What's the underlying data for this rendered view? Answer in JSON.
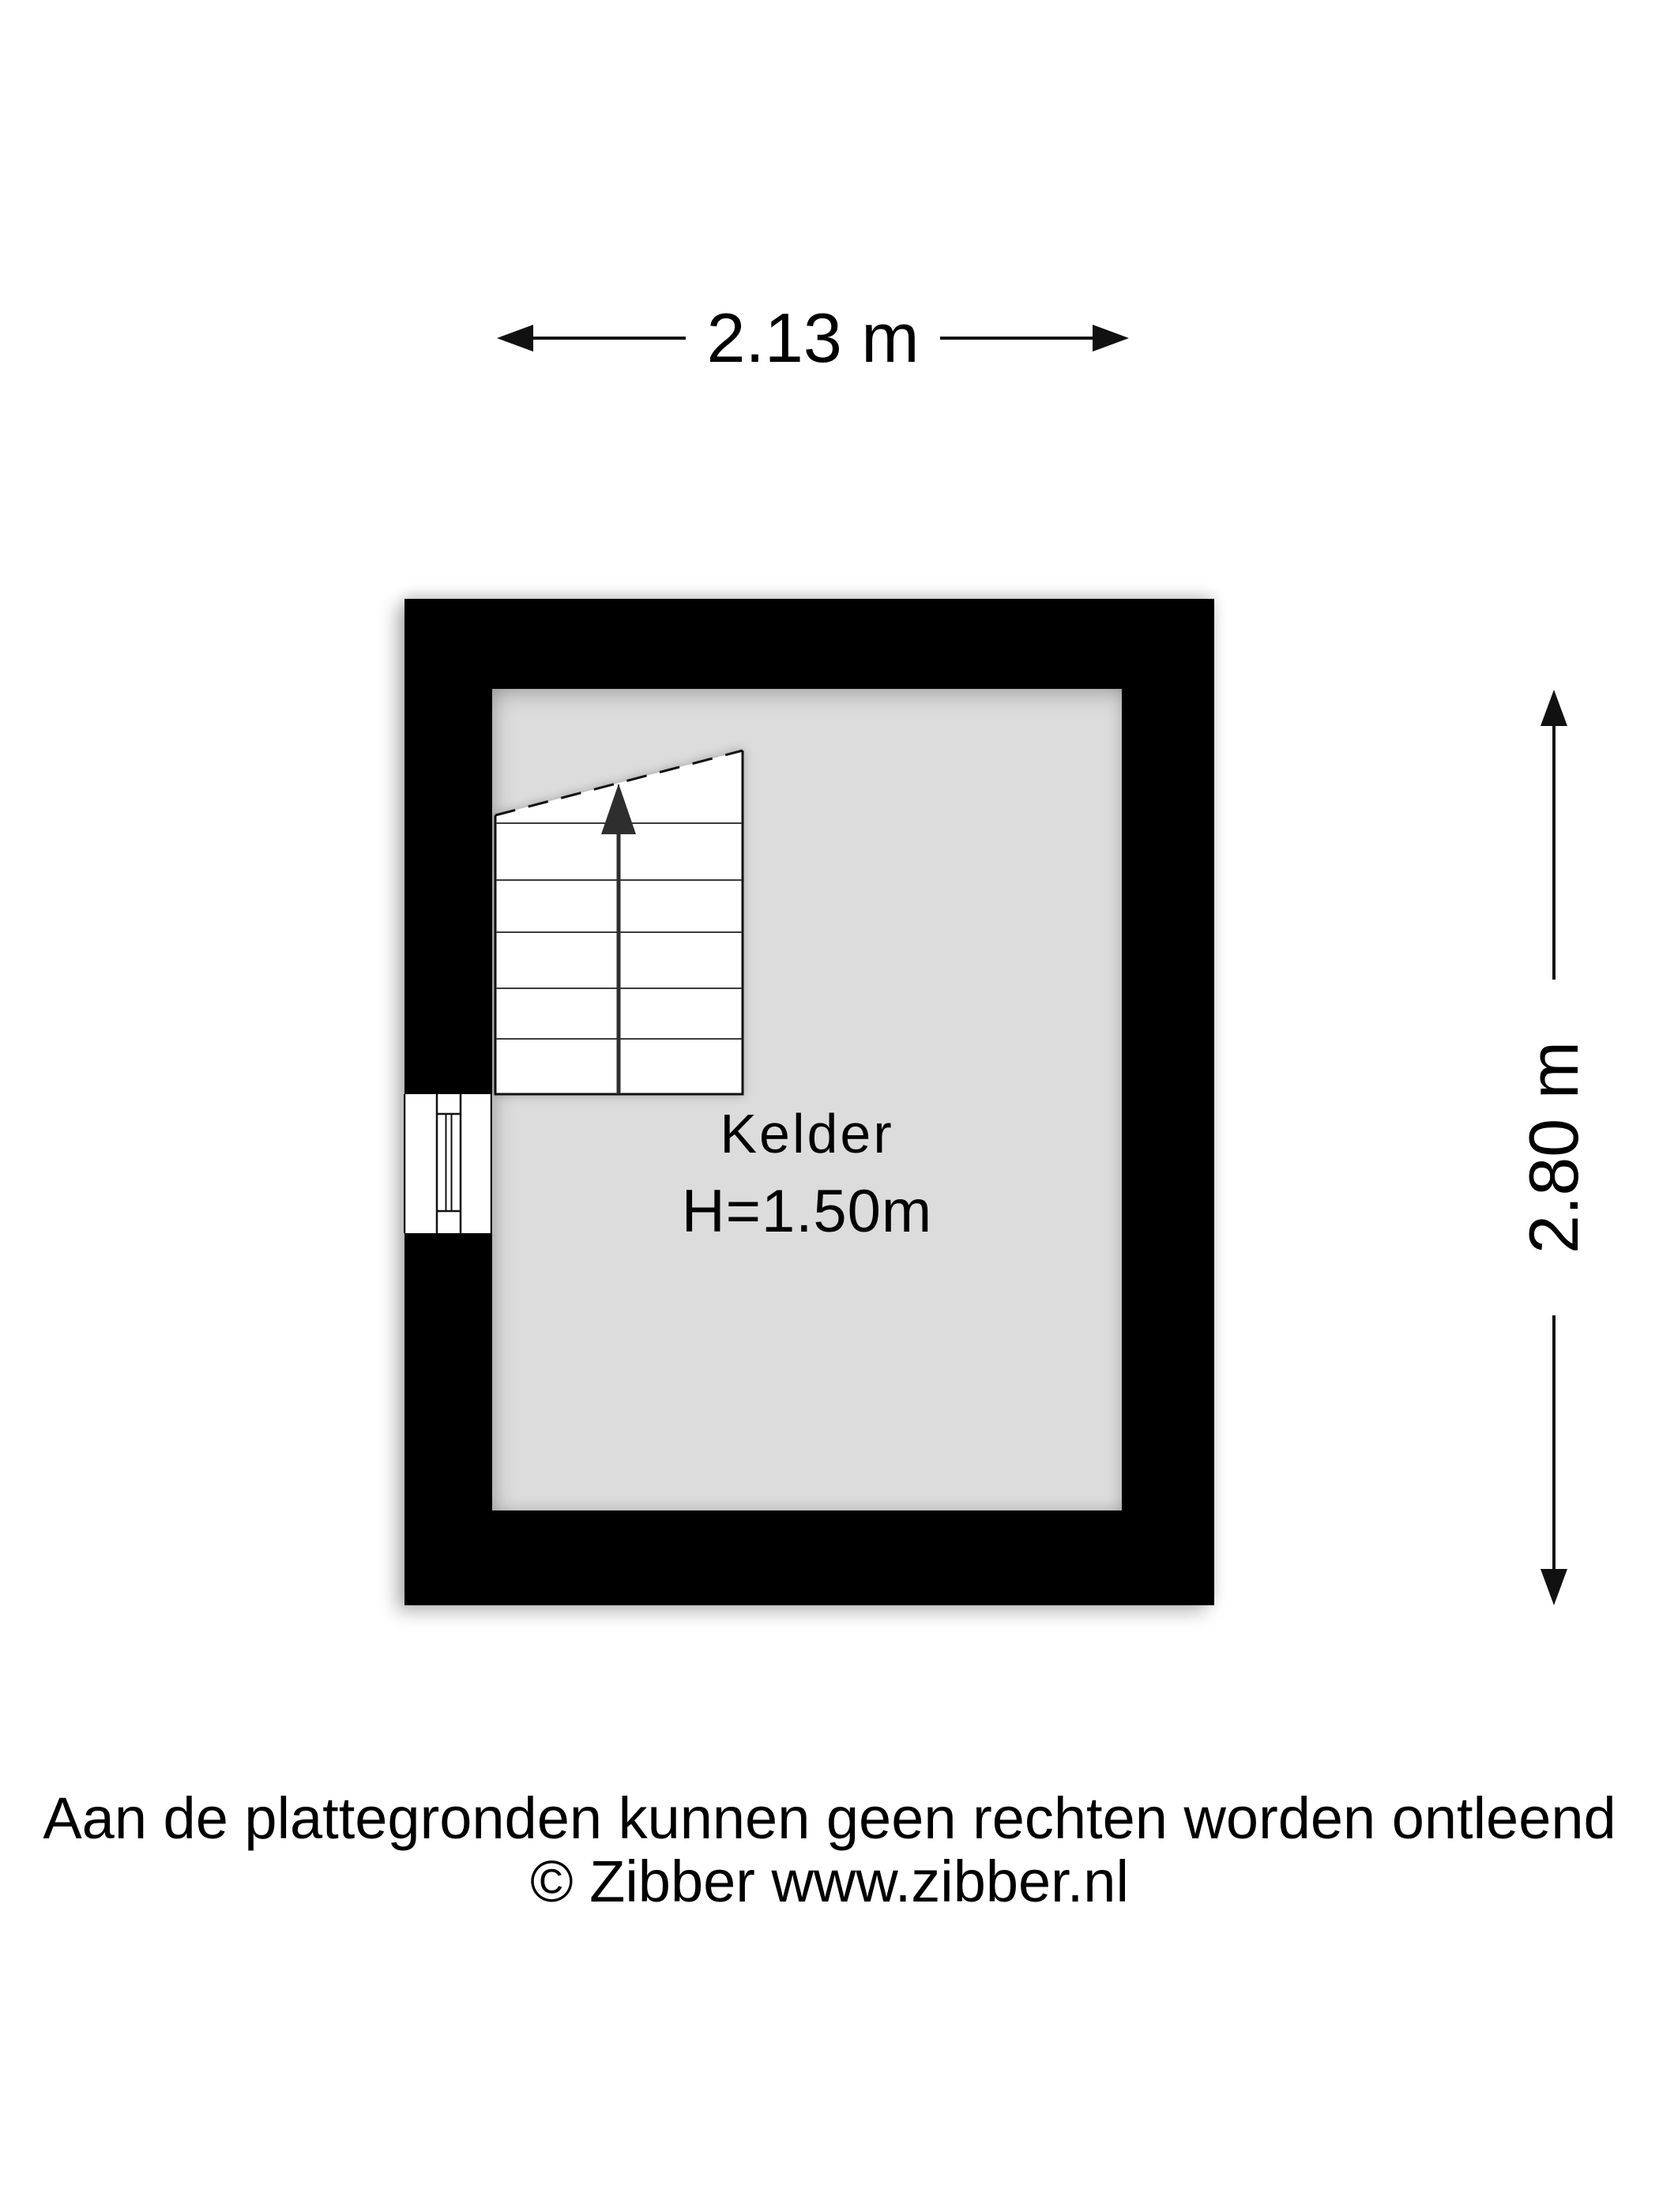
{
  "dimensions": {
    "width_label": "2.13 m",
    "height_label": "2.80 m"
  },
  "room": {
    "name": "Kelder",
    "height_label": "H=1.50m"
  },
  "symbols": {
    "stairs": "staircase-with-up-arrow",
    "stairs_cut_line": "dashed-diagonal-cut-line",
    "window": "window-symbol",
    "dimension_arrows": "double-headed-arrow"
  },
  "footer": {
    "line1": "Aan de plattegronden kunnen geen rechten worden ontleend",
    "line2": "© Zibber www.zibber.nl"
  },
  "colors": {
    "bg": "#ffffff",
    "wall": "#000000",
    "floor": "#dcdcdc",
    "line": "#111111",
    "steps": "#3d3d3d",
    "stair-arrow": "#2e2e2e",
    "text": "#000000"
  }
}
